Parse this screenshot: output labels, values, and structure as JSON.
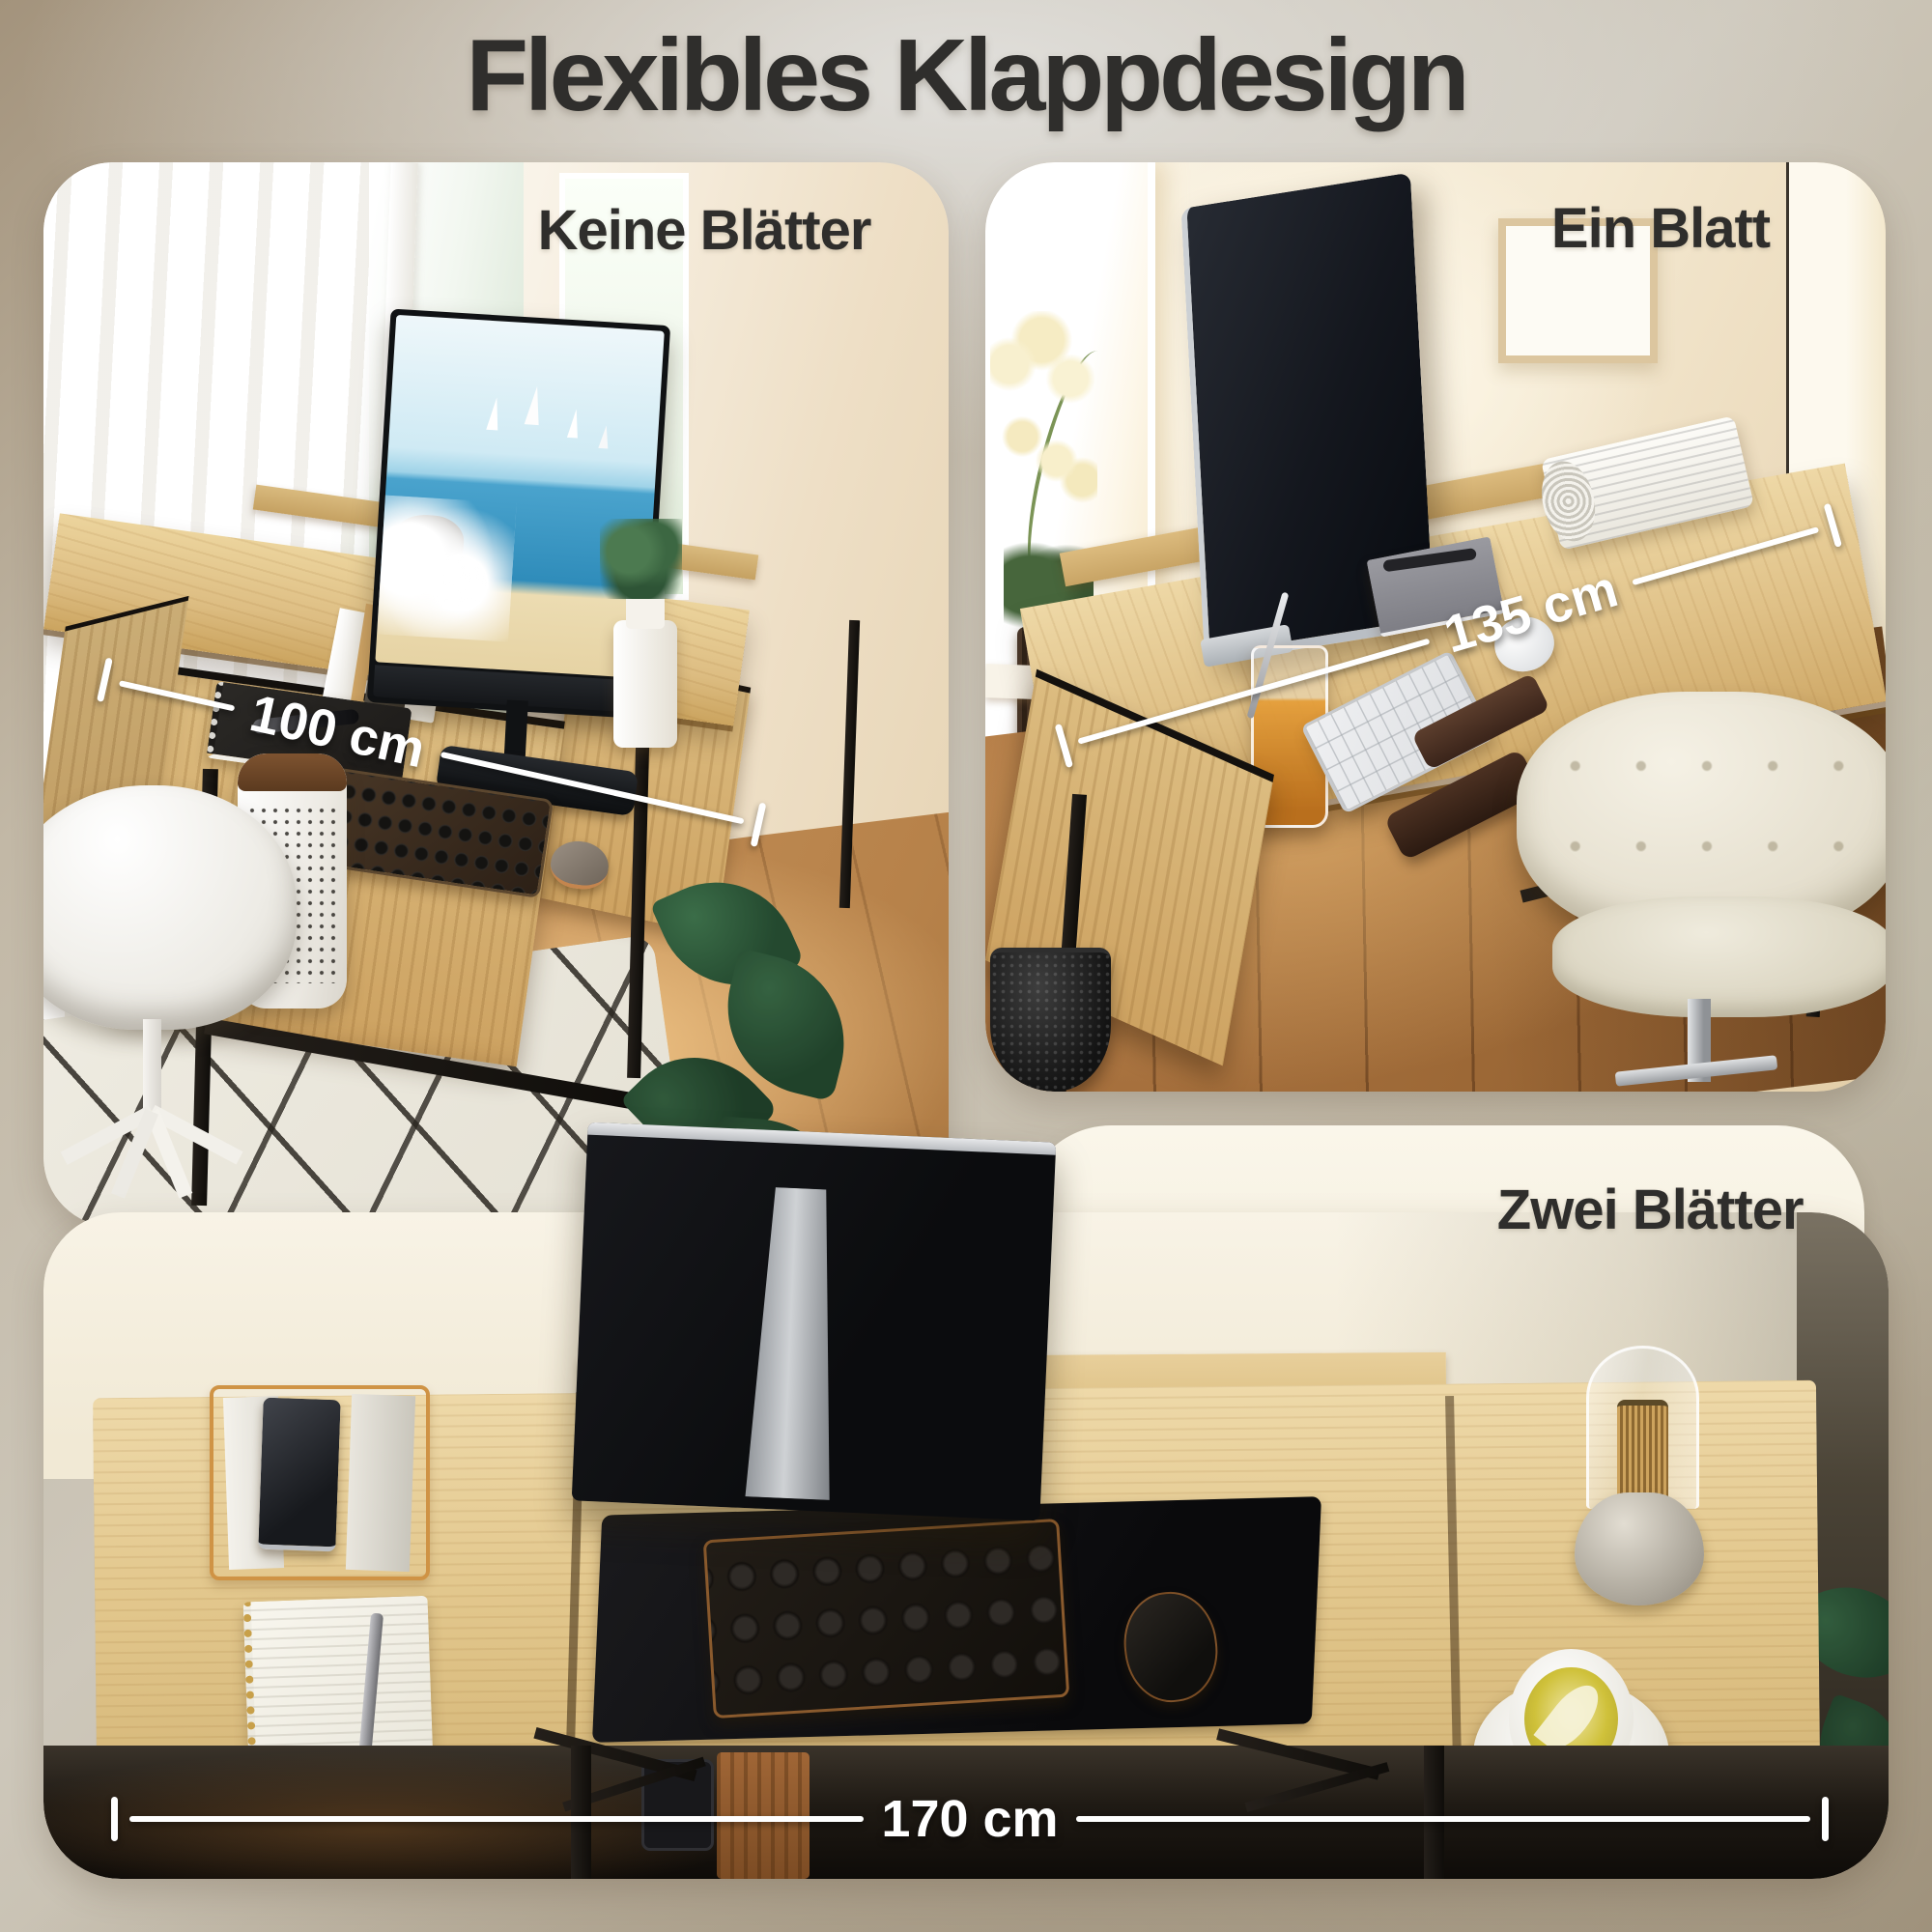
{
  "title": "Flexibles Klappdesign",
  "panels": {
    "no_leaves": {
      "label": "Keine Blätter",
      "dimension": "100 cm"
    },
    "one_leaf": {
      "label": "Ein Blatt",
      "dimension": "135 cm"
    },
    "two_leaves": {
      "label": "Zwei Blätter",
      "dimension": "170 cm"
    }
  },
  "colors": {
    "background_taupe": "#b3a794",
    "text_dark": "#2f2e2c",
    "annotation_white": "#ffffff",
    "wood_oak": "#dcbc80",
    "frame_black": "#17130f"
  }
}
